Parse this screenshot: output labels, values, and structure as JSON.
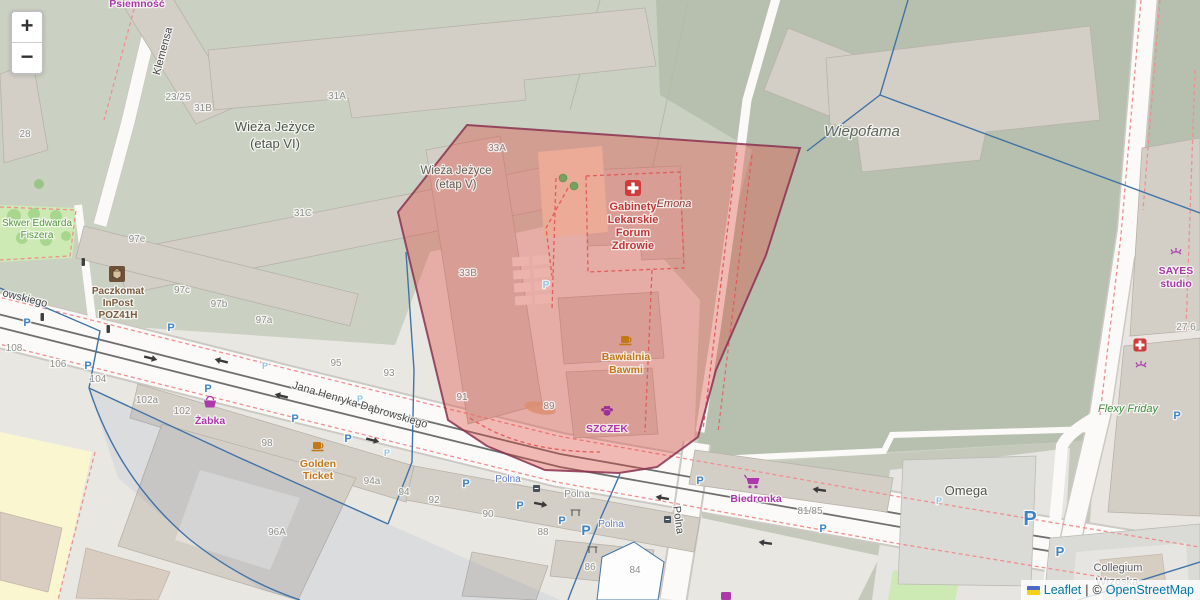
{
  "controls": {
    "zoom_in": "+",
    "zoom_out": "−"
  },
  "attribution": {
    "leaflet": "Leaflet",
    "divider": "|",
    "copyright_symbol": "©",
    "osm": "OpenStreetMap"
  },
  "colors": {
    "overlay_fill": "rgba(224,68,60,0.36)",
    "overlay_stroke": "#8a3150",
    "boundary_blue": "#4273a6",
    "link_blue": "#0078a8",
    "shop_purple": "#ac39ac",
    "poi_orange": "#c07818",
    "poi_red": "#c13636",
    "parking_blue": "#3d85c6",
    "field_green": "#b7c0ae",
    "residential_green": "#cbd1c2"
  },
  "labels": {
    "areas": {
      "psiemnosc": "Psiemność",
      "wieza6_1": "Wieża Jeżyce",
      "wieza6_2": "(etap VI)",
      "wieza5_1": "Wieża Jeżyce",
      "wieza5_2": "(etap V)",
      "wiepofama": "Wiepofama",
      "skwer_1": "Skwer Edwarda",
      "skwer_2": "Fiszera",
      "omega": "Omega",
      "collegium_1": "Collegium",
      "collegium_2": "Wrzoska"
    },
    "streets": {
      "klemensa": "Klemensa",
      "dabrowskiego": "Jana Henryka Dąbrowskiego",
      "dabrowskiego_frag": "owskiego",
      "polna": "Polna"
    },
    "stops": {
      "polna_1": "Polna",
      "polna_2": "Polna",
      "polna_gray": "Polna"
    },
    "pois": {
      "gabinety_1": "Gabinety",
      "gabinety_2": "Lekarskie",
      "gabinety_3": "Forum",
      "gabinety_4": "Zdrowie",
      "emona": "Emona",
      "paczkomat_1": "Paczkomat",
      "paczkomat_2": "InPost",
      "paczkomat_3": "POZ41H",
      "zabka": "Żabka",
      "golden_1": "Golden",
      "golden_2": "Ticket",
      "biedronka": "Biedronka",
      "bawialnia_1": "Bawialnia",
      "bawialnia_2": "Bawmi",
      "szczek": "SZCZEK",
      "sayes_1": "SAYES",
      "sayes_2": "studio",
      "flexy": "Flexy Friday"
    },
    "housenumbers": {
      "h23_25": "23/25",
      "h28": "28",
      "h31a": "31A",
      "h31b": "31B",
      "h31c": "31C",
      "h33a": "33A",
      "h33b": "33B",
      "h97e": "97e",
      "h97c": "97c",
      "h97b": "97b",
      "h97a": "97a",
      "h95": "95",
      "h93": "93",
      "h91": "91",
      "h89": "89",
      "h108": "108",
      "h106": "106",
      "h104": "104",
      "h102a": "102a",
      "h102": "102",
      "h98": "98",
      "h96a": "96A",
      "h94a": "94a",
      "h94": "94",
      "h92": "92",
      "h90": "90",
      "h88": "88",
      "h86": "86",
      "h84": "84",
      "h81_85": "81/85",
      "h27_6": "27.6"
    },
    "parking_glyph": "P"
  }
}
